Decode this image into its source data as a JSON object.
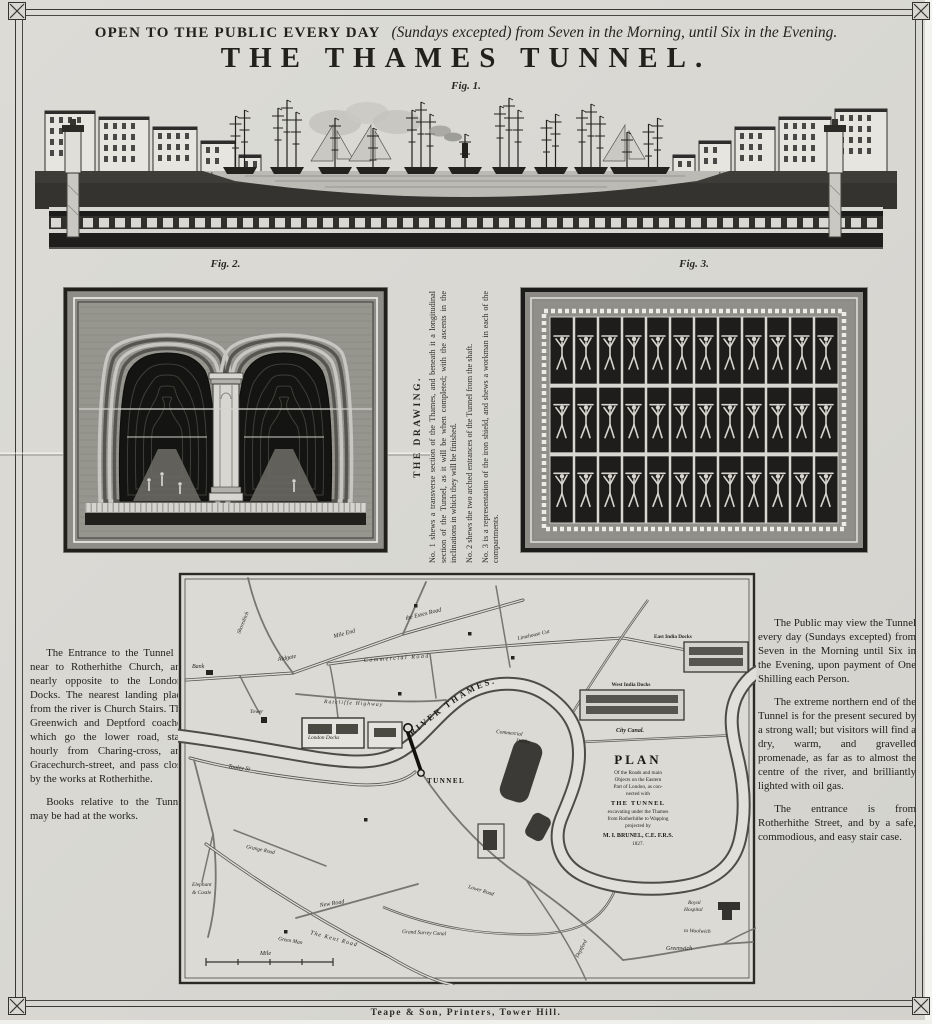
{
  "header": {
    "open_bold": "OPEN TO THE PUBLIC EVERY DAY",
    "open_italic": "(Sundays excepted) from Seven in the Morning, until Six in the Evening.",
    "title": "THE THAMES TUNNEL."
  },
  "figures": {
    "fig1_caption": "Fig. 1.",
    "fig2_caption": "Fig. 2.",
    "fig3_caption": "Fig. 3."
  },
  "drawing_notes": {
    "heading": "THE DRAWING.",
    "note1": "No. 1 shews a transverse section of the Thames, and beneath it a longitudinal section of the Tunnel, as it will be when completed; with the ascents in the inclinations in which they will be finished.",
    "note2": "No. 2 shews the two arched entrances of the Tunnel from the shaft.",
    "note3": "No. 3 is a representation of the iron shield, and shews a workman in each of the compartments."
  },
  "left_column": {
    "para1": "The Entrance to the Tunnel is near to Rotherhithe Church, and nearly opposite to the London-Docks. The nearest landing place from the river is Church Stairs. The Greenwich and Deptford coaches which go the lower road, start hourly from Charing-cross, and Gracechurch-street, and pass close by the works at Rotherhithe.",
    "para2": "Books relative to the Tunnel may be had at the works."
  },
  "right_column": {
    "para1": "The Public may view the Tunnel every day (Sundays excepted) from Seven in the Morning until Six in the Evening, upon payment of One Shilling each Person.",
    "para2": "The extreme northern end of the Tunnel is for the present secured by a strong wall; but visitors will find a dry, warm, and gravelled promenade, as far as to almost the centre of the river, and brilliantly lighted with oil gas.",
    "para3": "The entrance is from Rotherhithe Street, and by a safe, commodious, and easy stair case."
  },
  "map": {
    "labels": {
      "river": "RIVER THAMES.",
      "tunnel": "TUNNEL",
      "bank": "Bank",
      "tower": "Tower",
      "shoreditch": "Shoreditch",
      "mile_end": "Mile End",
      "essex_road": "the Essex Road",
      "aldgate": "Aldgate",
      "commercial_road": "Commercial Road",
      "limehouse_cut": "Limehouse Cut",
      "east_india_docks": "East India Docks",
      "west_india_docks": "West India Docks",
      "city_canal": "City Canal.",
      "ratcliffe_highway": "Ratcliffe Highway",
      "london_docks": "London Docks",
      "commercial_docks_1": "Commercial",
      "commercial_docks_2": "Docks",
      "tooley_st": "Tooley St",
      "grange_road": "Grange Road",
      "elephant_1": "Elephant",
      "elephant_2": "& Castle",
      "new_road": "New Road",
      "green_man": "Green Man",
      "kent_road": "The Kent Road",
      "grand_surrey_canal": "Grand Surrey Canal",
      "lower_road": "Lower Road",
      "deptford": "Deptford",
      "greenwich": "Greenwich",
      "to_woolwich": "to Woolwich",
      "royal_hospital_1": "Royal",
      "royal_hospital_2": "Hospital",
      "mile": "Mile"
    },
    "plan": {
      "title": "PLAN",
      "line1": "Of the Roads and main",
      "line2": "Objects on the Eastern",
      "line3": "Part of London, as con-",
      "line4": "nected with",
      "tunnel": "THE TUNNEL",
      "line5": "excavating under the Thames",
      "line6": "from Rotherhithe to Wapping",
      "line7": "projected by",
      "author": "M. I. BRUNEL, C.E. F.R.S.",
      "year": "1827."
    }
  },
  "footer": {
    "imprint": "Teape & Son, Printers, Tower Hill."
  },
  "colors": {
    "paper": "#d9d8d3",
    "ink": "#23211c",
    "engraving_dark": "#1e1d1b",
    "engraving_mid": "#8f8e89"
  }
}
